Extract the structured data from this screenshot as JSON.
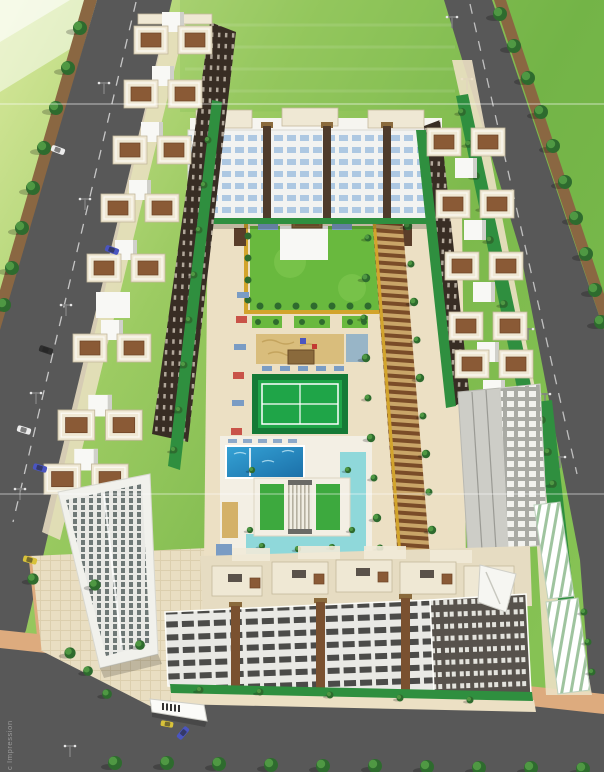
{
  "caption": {
    "text": "c Impression"
  },
  "palette": {
    "grass": "#8fc05a",
    "grassLight": "#d8e89c",
    "grassDeep": "#6fae44",
    "asphalt": "#585858",
    "roadLine": "#d9d9d9",
    "dirt": "#8a6742",
    "kerb": "#ddab7e",
    "pave": "#ece0c4",
    "cream": "#efe8d4",
    "creamEdge": "#c3b89c",
    "white": "#f8f8f5",
    "roofBrown": "#8a5a36",
    "faceDark": "#382d24",
    "hedge": "#2f8f3f",
    "treeDark": "#2e6b2e",
    "treeLight": "#55a047",
    "lawn": "#69b93e",
    "courtGreen": "#1fa548",
    "courtDark": "#157a36",
    "pathYellow": "#d2a42c",
    "sand": "#d9bd7c",
    "poolBlue": "#2a93c9",
    "aqua": "#8fd8da",
    "pergola": "#7a4c28",
    "pergolaBg": "#c9a568",
    "matBlue": "#7a9cc4",
    "flowerRed": "#c33a32",
    "carWhite": "#ececec",
    "carBlue": "#4a55c0",
    "carTaxi": "#d8c23a",
    "carBlack": "#2e2e2e",
    "caption": "#9a9a9a"
  },
  "scene": {
    "type": "aerial-architectural-rendering",
    "elements": [
      "grass-field",
      "perimeter-road-left",
      "perimeter-road-right",
      "perimeter-road-bottom",
      "roadside-trees",
      "street-lamps",
      "left-apartment-wing",
      "right-apartment-wing",
      "top-apartment-block",
      "bottom-apartment-block",
      "left-corner-tower",
      "right-corner-tower",
      "central-lawn-garden",
      "kids-play-sand-area",
      "sports-court",
      "swimming-pool",
      "clubhouse-courtyard",
      "water-features",
      "pergola-walkway",
      "parking-canopies",
      "entrance-gates",
      "cars"
    ]
  }
}
